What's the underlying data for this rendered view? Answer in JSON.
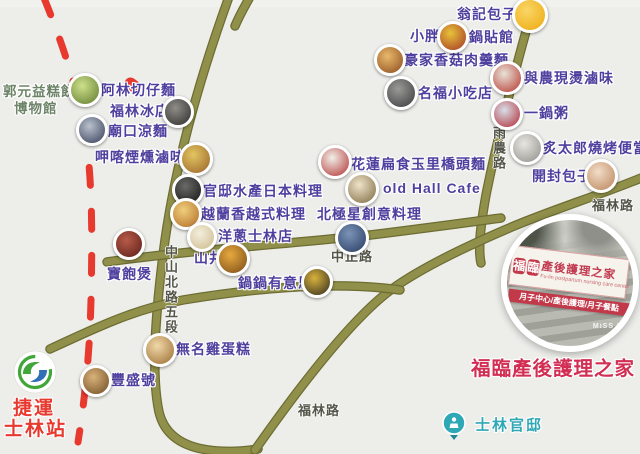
{
  "map": {
    "background": "#edeeea",
    "road_color": "#90904a",
    "metro_line_color": "#e8392f",
    "poi_label_color": "#4f3f9e"
  },
  "road_labels": [
    {
      "id": "yunong-road",
      "text": "雨農路",
      "x": 489,
      "y": 126,
      "vertical": true
    },
    {
      "id": "zhongshan-n-road",
      "text": "中山北路五段",
      "x": 161,
      "y": 245,
      "vertical": true
    },
    {
      "id": "zhongzheng-road",
      "text": "中正路",
      "x": 331,
      "y": 246,
      "vertical": false
    },
    {
      "id": "fulin-road-ne",
      "text": "福林路",
      "x": 592,
      "y": 195,
      "vertical": false
    },
    {
      "id": "fulin-road-south",
      "text": "福林路",
      "x": 298,
      "y": 400,
      "vertical": false
    }
  ],
  "pois": [
    {
      "id": "wengji-baozi",
      "label": "翁記包子",
      "lx": 457,
      "ly": 7,
      "ix": 530,
      "iy": 15,
      "r": 15,
      "c1": "#f9d667",
      "c2": "#eda90c"
    },
    {
      "id": "xiaopang-guotieguan",
      "label": "小胖",
      "lx": 410,
      "ly": 29,
      "label2": "鍋貼館",
      "l2x": 469,
      "l2y": 30,
      "ix": 453,
      "iy": 37,
      "r": 13,
      "c1": "#e8c23a",
      "c2": "#a33426"
    },
    {
      "id": "haojia-xianggu-rougeng",
      "label": "豪家香菇肉羹麵",
      "lx": 404,
      "ly": 53,
      "ix": 390,
      "iy": 60,
      "r": 13,
      "c1": "#e9b96a",
      "c2": "#8a4a1e"
    },
    {
      "id": "yunong-xiantang-luwei",
      "label": "與農現燙滷味",
      "lx": 524,
      "ly": 71,
      "ix": 507,
      "iy": 78,
      "r": 14,
      "c1": "#e8e2d8",
      "c2": "#b5342c"
    },
    {
      "id": "mingfu-xiaochidian",
      "label": "名福小吃店",
      "lx": 418,
      "ly": 86,
      "ix": 401,
      "iy": 93,
      "r": 14,
      "c1": "#9a9a98",
      "c2": "#3a3a3c"
    },
    {
      "id": "yiguozhou",
      "label": "一鍋粥",
      "lx": 524,
      "ly": 106,
      "ix": 507,
      "iy": 114,
      "r": 13,
      "c1": "#d8dee8",
      "c2": "#b02a32"
    },
    {
      "id": "zhitailang-shaokao",
      "label": "炙太郎燒烤便當",
      "lx": 543,
      "ly": 141,
      "ix": 527,
      "iy": 148,
      "r": 14,
      "c1": "#e8e6e0",
      "c2": "#8e8e8a"
    },
    {
      "id": "kaifeng-baozi",
      "label": "開封包子",
      "lx": 532,
      "ly": 169,
      "ix": 601,
      "iy": 176,
      "r": 14,
      "c1": "#f2ddc8",
      "c2": "#b98358"
    },
    {
      "id": "alin-qiezaimian",
      "label": "阿林切仔麵",
      "lx": 101,
      "ly": 83,
      "ix": 85,
      "iy": 90,
      "r": 14,
      "c1": "#cfe08a",
      "c2": "#5d7a2e"
    },
    {
      "id": "fulin-bingdian",
      "label": "福林冰店",
      "lx": 110,
      "ly": 104,
      "ix": 178,
      "iy": 112,
      "r": 13,
      "c1": "#8f8d88",
      "c2": "#2e2c2a"
    },
    {
      "id": "miaokou-liangmian",
      "label": "廟口涼麵",
      "lx": 108,
      "ly": 124,
      "ix": 92,
      "iy": 130,
      "r": 13,
      "c1": "#b9c2cc",
      "c2": "#343c58"
    },
    {
      "id": "jiaka-yanxun-luwei",
      "label": "呷喀煙燻滷味",
      "lx": 95,
      "ly": 150,
      "ix": 196,
      "iy": 159,
      "r": 14,
      "c1": "#e3c560",
      "c2": "#97622a"
    },
    {
      "id": "guandi-shuichan-riben",
      "label": "官邸水產日本料理",
      "lx": 203,
      "ly": 184,
      "ix": 188,
      "iy": 190,
      "r": 13,
      "c1": "#6a6a68",
      "c2": "#141414"
    },
    {
      "id": "yuelanxiang-yueshi",
      "label": "越蘭香越式料理",
      "lx": 201,
      "ly": 207,
      "ix": 186,
      "iy": 214,
      "r": 13,
      "c1": "#f0cf7a",
      "c2": "#b06a28"
    },
    {
      "id": "yangcong-shilin",
      "label": "洋蔥士林店",
      "lx": 218,
      "ly": 229,
      "ix": 202,
      "iy": 237,
      "r": 12,
      "c1": "#f4eedd",
      "c2": "#cbb98a"
    },
    {
      "id": "shanjing",
      "label": "山井",
      "lx": 194,
      "ly": 251,
      "ix": 233,
      "iy": 259,
      "r": 14,
      "c1": "#e6a93e",
      "c2": "#7a4a18"
    },
    {
      "id": "guoguo-youyisi",
      "label": "鍋鍋有意思",
      "lx": 238,
      "ly": 276,
      "ix": 317,
      "iy": 282,
      "r": 13,
      "c1": "#d8b23c",
      "c2": "#2f2a20"
    },
    {
      "id": "baobaobao",
      "label": "寶飽煲",
      "lx": 107,
      "ly": 267,
      "ix": 129,
      "iy": 244,
      "r": 13,
      "c1": "#b85a4a",
      "c2": "#5a1f16"
    },
    {
      "id": "hualien-bianshi-qiaotou",
      "label": "花蓮扁食玉里橋頭麵",
      "lx": 351,
      "ly": 157,
      "ix": 335,
      "iy": 162,
      "r": 14,
      "c1": "#f2efe8",
      "c2": "#b03030"
    },
    {
      "id": "old-hall-cafe",
      "label": "old Hall Cafe",
      "lx": 383,
      "ly": 181,
      "ix": 362,
      "iy": 189,
      "r": 14,
      "c1": "#efe3c8",
      "c2": "#7a6840"
    },
    {
      "id": "beijixing-chuangyi",
      "label": "北極星創意料理",
      "lx": 317,
      "ly": 207,
      "ix": 352,
      "iy": 238,
      "r": 14,
      "c1": "#7a94b8",
      "c2": "#273a5e"
    },
    {
      "id": "wuming-jidangao",
      "label": "無名雞蛋糕",
      "lx": 176,
      "ly": 342,
      "ix": 160,
      "iy": 350,
      "r": 14,
      "c1": "#f0d9a8",
      "c2": "#9a6a30"
    },
    {
      "id": "fengshenghao",
      "label": "豐盛號",
      "lx": 111,
      "ly": 373,
      "ix": 96,
      "iy": 381,
      "r": 13,
      "c1": "#d9b37a",
      "c2": "#6e4a22"
    }
  ],
  "museum": {
    "line1": "郭元益糕餅",
    "line2": "博物館",
    "color": "#6e8468"
  },
  "metro_station": {
    "line1": "捷運",
    "line2": "士林站",
    "color": "#e8392f"
  },
  "residence": {
    "label": "士林官邸",
    "color": "#2fa8b6"
  },
  "care_center": {
    "label": "福臨產後護理之家",
    "color": "#d22d52"
  },
  "inset": {
    "brand_1": "福",
    "brand_2": "臨",
    "title": "產後護理之家",
    "subtitle": "Fu-lin postpartum nursing care center",
    "strip": "月子中心/產後護理/月子餐點",
    "watermark": "MiSS B"
  }
}
